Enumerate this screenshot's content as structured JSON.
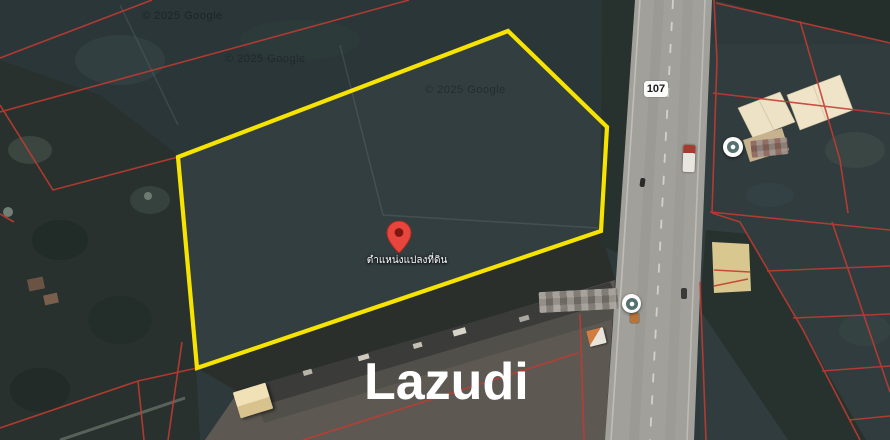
{
  "map": {
    "brand_watermark": "Lazudi",
    "provider_copyright": "© 2025 Google",
    "route_badge": {
      "number": "107"
    },
    "location_pin": {
      "label": "ตำแหน่งแปลงที่ดิน"
    },
    "colors": {
      "plot_outline": "#F6E400",
      "cadastral_line": "#C23B31",
      "pin": "#E8453C",
      "road": "#A2A09A"
    }
  }
}
